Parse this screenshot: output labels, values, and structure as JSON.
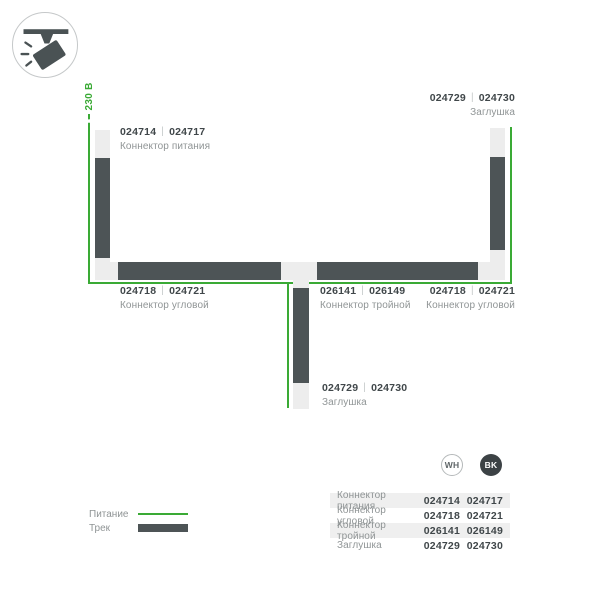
{
  "separator": "|",
  "voltage_label": "~ 230 В",
  "palette": {
    "power_green": "#3aaa35",
    "track_dark": "#4d5456",
    "connector_light": "#ededed",
    "text_dark": "#40474a",
    "text_gray": "#8f9495",
    "stripe_bg": "#efefef",
    "bk_badge": "#3c4245"
  },
  "icon": {
    "name": "track-spotlight"
  },
  "diagram": {
    "labels": {
      "power": {
        "code_wh": "024714",
        "code_bk": "024717",
        "name": "Коннектор питания"
      },
      "endcap_top": {
        "code_wh": "024729",
        "code_bk": "024730",
        "name": "Заглушка"
      },
      "corner_left": {
        "code_wh": "024718",
        "code_bk": "024721",
        "name": "Коннектор угловой"
      },
      "triple": {
        "code_wh": "026141",
        "code_bk": "026149",
        "name": "Коннектор тройной"
      },
      "corner_right": {
        "code_wh": "024718",
        "code_bk": "024721",
        "name": "Коннектор угловой"
      },
      "endcap_bottom": {
        "code_wh": "024729",
        "code_bk": "024730",
        "name": "Заглушка"
      }
    }
  },
  "legend": {
    "power_label": "Питание",
    "track_label": "Трек"
  },
  "color_badges": {
    "wh": "WH",
    "bk": "BK"
  },
  "table": {
    "rows": [
      {
        "name": "Коннектор питания",
        "wh": "024714",
        "bk": "024717"
      },
      {
        "name": "Коннектор угловой",
        "wh": "024718",
        "bk": "024721"
      },
      {
        "name": "Коннектор тройной",
        "wh": "026141",
        "bk": "026149"
      },
      {
        "name": "Заглушка",
        "wh": "024729",
        "bk": "024730"
      }
    ]
  }
}
